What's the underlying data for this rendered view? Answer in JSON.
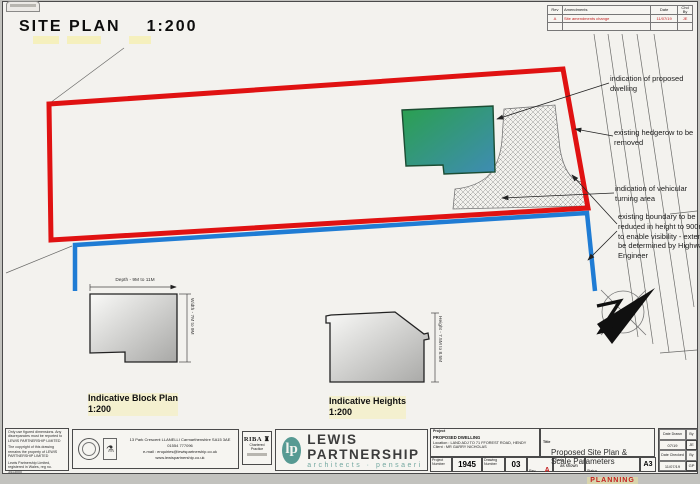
{
  "sheet": {
    "title": "SITE PLAN",
    "title_scale": "1:200"
  },
  "revision_table": {
    "col_rev": "Rev",
    "col_amendments": "Amendments",
    "col_date": "Date",
    "col_chd": "Chd By",
    "row": {
      "rev": "A",
      "amendment": "Site amendments change",
      "date": "11/07/19",
      "chd": "JE"
    }
  },
  "annotations": [
    "indication of proposed dwelling",
    "existing hedgerow to be removed",
    "indication of vehicular turning area",
    "existing boundary to be reduced in height to 900mm to enable visibility - extent to be determined by Highways Engineer"
  ],
  "block_plan": {
    "dim_depth": "Depth - 9M to 11M",
    "dim_width": "Width - 7M to 9M",
    "caption": "Indicative Block Plan",
    "scale": "1:200"
  },
  "heights": {
    "dim_height": "Height - 7.5M to 8.5M",
    "caption": "Indicative Heights",
    "scale": "1:200"
  },
  "colors": {
    "boundary_red": "#e01212",
    "blue_line": "#1f7cd4",
    "dwelling_green": "#2aa04e",
    "brand_teal": "#579a93",
    "status_red": "#c42020"
  },
  "title_block": {
    "disclaimer1": "Only use figured dimensions. Any discrepancies must be reported to LEWIS PARTNERSHIP LIMITED",
    "disclaimer2": "The copyright of this drawing remains the property of LEWIS PARTNERSHIP LIMITED",
    "disclaimer3": "Lewis Partnership Limited, registered in Wales, reg no. 3413000",
    "address_line1": "13  Park Crescent   LLANELLI   Carmarthenshire   SA15 3AE",
    "address_line2": "01554 777096",
    "address_line3": "e-mail : enquiries@lewispartnership.co.uk",
    "address_line4": "www.lewispartnership.co.uk",
    "riba": {
      "name": "RIBA",
      "sub": "Chartered Practice"
    },
    "brand": {
      "initials": "lp",
      "name": "LEWIS PARTNERSHIP",
      "tagline": "architects · pensaeri"
    },
    "project": {
      "label": "Project",
      "name": "PROPOSED DWELLING",
      "location_label": "Location :",
      "location": "LAND ADJ TO 71 FFOREST ROAD, HENDY",
      "client_label": "Client :",
      "client": "MR GARRY NICHOLAS"
    },
    "numbers": {
      "project_number_label": "Project Number",
      "project_number": "1945",
      "drawing_number_label": "Drawing Number",
      "drawing_number": "03",
      "rev_label": "Rev.",
      "rev": "A",
      "scale_label": "Scale",
      "scale_value": "as shown",
      "status_label": "Status",
      "status": "PLANNING"
    },
    "titlebox": {
      "label": "Title",
      "line1": "Proposed Site Plan &",
      "line2": "Scale Parameters"
    },
    "paper_size": "A3",
    "dates": {
      "drawn_label": "Date Drawn",
      "drawn": "07/19",
      "drawn_by_label": "By",
      "drawn_by": "JE",
      "checked_label": "Date Checked",
      "checked": "11/07/19",
      "checked_by_label": "By",
      "checked_by": "GP"
    }
  }
}
